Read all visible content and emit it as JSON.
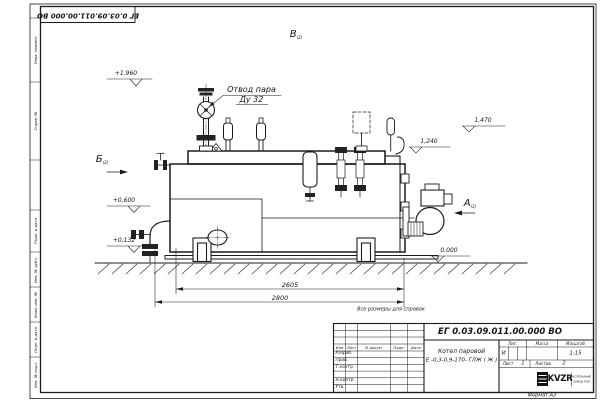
{
  "sheet": {
    "designation_top": "ЕГ 0.03.09.011.00.000  ВО",
    "format_note": "Формат А3",
    "reference_note": "Все размеры для справок",
    "left_margin_labels": [
      "Перв. примен.",
      "Справ. №",
      "Подп. и дата",
      "Инв. № дубл.",
      "Взам. инв. №",
      "Подп. и дата",
      "Инв. № подл."
    ]
  },
  "drawing": {
    "steam_annotation": {
      "line1": "Отвод пара",
      "line2": "Ду 32"
    },
    "view_markers": {
      "top": "В",
      "left": "Б",
      "right": "А",
      "sheet_ref": "(2)"
    },
    "elevations": {
      "steam_top": "+1,960",
      "right_upper": "1,470",
      "right_lower": "1,240",
      "left_mid": "+0,600",
      "left_low": "+0,132",
      "ground": "0,000"
    },
    "dimensions": {
      "inner_length": "2605",
      "overall_length": "2800"
    }
  },
  "title_block": {
    "designation": "ЕГ 0.03.09.011.00.000  ВО",
    "product_name_line1": "Котел паровой",
    "product_name_line2": "Е -0,3-0,9-170- ГЛЖ ( Ж )",
    "revision_header": [
      "Изм",
      "Лист",
      "N докум.",
      "Подп.",
      "Дата"
    ],
    "signature_rows": [
      "Разраб.",
      "Пров.",
      "Т.контр.",
      "Н.контр.",
      "Утв."
    ],
    "lit_header": "Лит.",
    "lit_value": "И",
    "mass_header": "Масса",
    "scale_header": "Масштаб",
    "scale_value": "1:15",
    "sheet_label": "Лист",
    "sheet_value": "1",
    "sheets_label": "Листов",
    "sheets_value": "2",
    "logo_text": "KVZR",
    "logo_sub_line1": "КОТЕЛЬНЫЙ",
    "logo_sub_line2": "ЗАВОД РЭП"
  }
}
